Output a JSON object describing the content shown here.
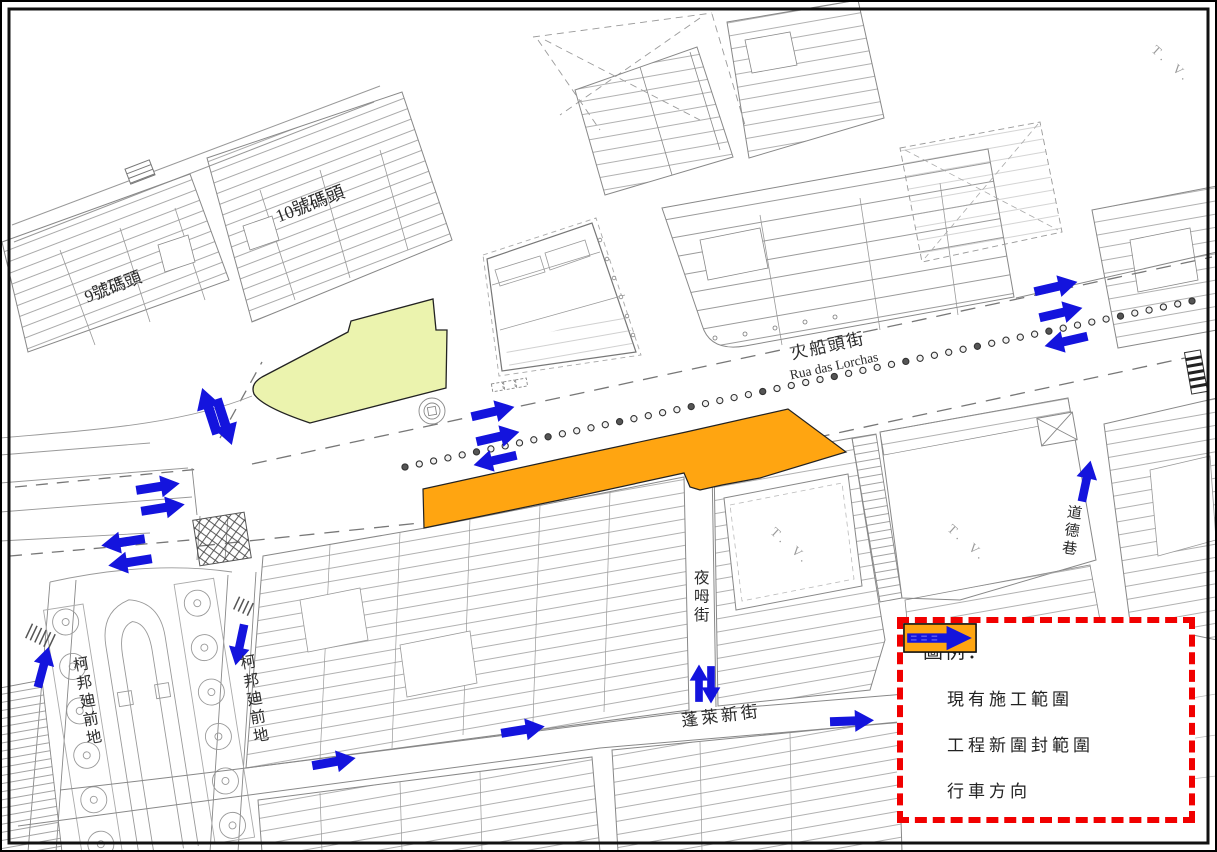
{
  "map": {
    "labels": {
      "pier_9": "9號碼頭",
      "pier_10": "10號碼頭",
      "fire_boat_street_zh": "火船頭街",
      "fire_boat_street_pt": "Rua das Lorchas",
      "ye_mou_street": "夜呣街",
      "pong_loi_new_street": "蓬萊新街",
      "praca_ponte_e_horta_west": "柯邦廸前地",
      "praca_ponte_e_horta_east": "柯邦廸前地",
      "morality_lane": "道德巷",
      "tv_mark_1": "T. V.",
      "tv_mark_2": "T. V.",
      "tv_mark_3": "T. V."
    }
  },
  "legend": {
    "title": "圖例：",
    "items": [
      {
        "id": "existing-works-area",
        "label": "現有施工範圍"
      },
      {
        "id": "new-enclosure-area",
        "label": "工程新圍封範圍"
      },
      {
        "id": "traffic-direction",
        "label": "行車方向"
      }
    ]
  },
  "colors": {
    "existing_area": "#ebf3ae",
    "new_enclosure": "#ffa511",
    "arrow_blue": "#1414dd",
    "legend_border": "#f10000"
  }
}
